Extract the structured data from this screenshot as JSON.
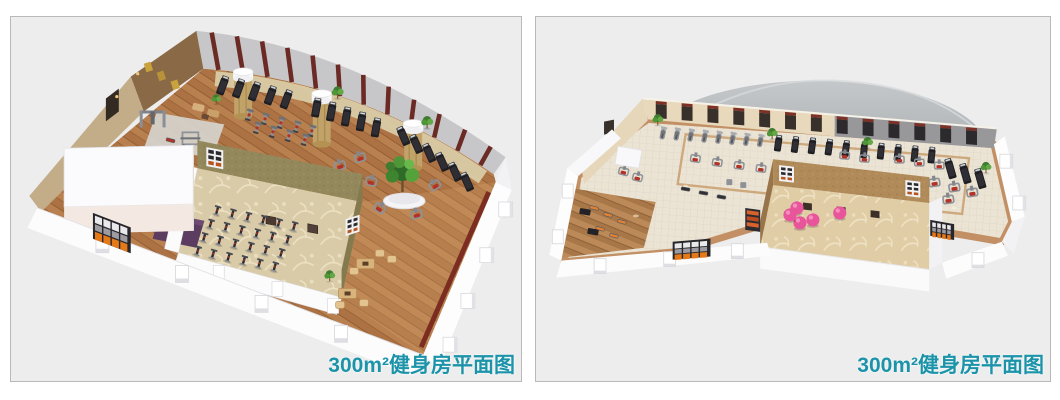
{
  "page": {
    "background_color": "#ffffff"
  },
  "panels": [
    {
      "name": "gym-floorplan-left",
      "caption": "300m²健身房平面图",
      "caption_color": "#1b93a9",
      "panel_background": "#ededee",
      "panel_border": "#b9b9bb",
      "features": [
        "curved-gray-back-wall-with-maroon-pillars",
        "treadmill-arc-row",
        "exercise-bike-rows",
        "stone-columns-with-white-caps",
        "weight-machines",
        "squat-rack",
        "cable-station",
        "large-indoor-plant-in-round-planter",
        "spinning-studio-with-patterned-carpet",
        "purple-mat",
        "lounge-tables-and-chairs",
        "orange-locker-shelves",
        "white-outer-walls-with-pillars"
      ],
      "colors": {
        "wood_floor": "#b9804f",
        "back_wall": "#c7c7c9",
        "wall_pillar": "#6b2a23",
        "stone_column": "#c1a268",
        "spin_room_wall": "#93885c",
        "spin_room_carpet": "#d9cba8",
        "purple_mat": "#5d3c62",
        "locker_orange": "#e57917",
        "treadmill_black": "#1f1f23",
        "machine_red": "#b23227",
        "plant_green": "#4f9638"
      }
    },
    {
      "name": "gym-floorplan-right",
      "caption": "300m²健身房平面图",
      "caption_color": "#1b93a9",
      "panel_background": "#ededee",
      "panel_border": "#b9b9bb",
      "features": [
        "curved-gray-canopy-roof",
        "cream-back-wall-with-dark-windows",
        "elliptical-stepper-row",
        "treadmill-rows",
        "strength-machines-with-red-seats",
        "flat-benches",
        "dumbbell-racks",
        "group-exercise-room-with-floral-carpet",
        "pink-gym-balls",
        "orange-locker-shelves",
        "wood-and-tile-floor",
        "white-outer-walls-with-pillars"
      ],
      "colors": {
        "tile_floor": "#ebe4d4",
        "wood_border": "#bb8a58",
        "canopy_gray": "#9aa0a3",
        "back_wall_cream": "#e8d8bc",
        "window_dark": "#38302a",
        "window_cap_maroon": "#7c3026",
        "room_wall_tan": "#b08a58",
        "room_carpet": "#e0cda5",
        "ball_pink": "#e8559a",
        "locker_orange": "#e57917",
        "machine_red": "#b23227"
      }
    }
  ]
}
